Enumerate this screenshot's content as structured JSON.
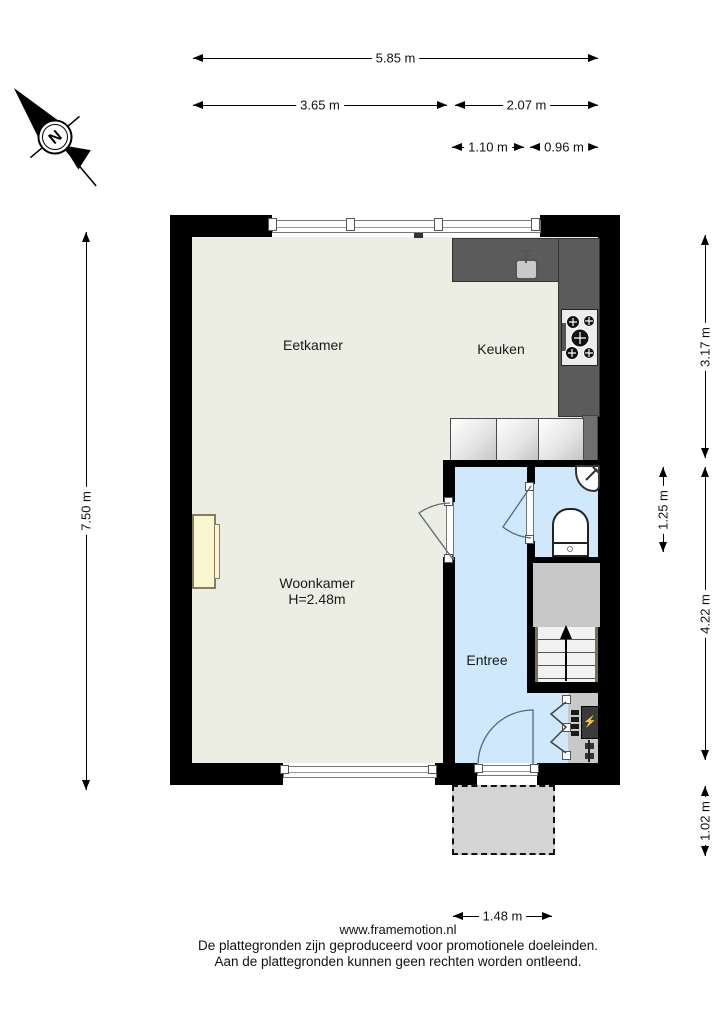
{
  "compass": {
    "north_label": "N"
  },
  "rooms": {
    "eetkamer": {
      "label": "Eetkamer"
    },
    "keuken": {
      "label": "Keuken"
    },
    "woonkamer": {
      "label": "Woonkamer",
      "ceiling_height": "H=2.48m"
    },
    "entree": {
      "label": "Entree"
    }
  },
  "dimensions": {
    "horizontal": [
      {
        "label": "5.85 m",
        "x": 193,
        "y": 58,
        "length": 405
      },
      {
        "label": "3.65 m",
        "x": 193,
        "y": 105,
        "length": 254
      },
      {
        "label": "2.07 m",
        "x": 455,
        "y": 105,
        "length": 143
      },
      {
        "label": "1.10 m",
        "x": 452,
        "y": 147,
        "length": 72
      },
      {
        "label": "0.96 m",
        "x": 530,
        "y": 147,
        "length": 68
      },
      {
        "label": "1.48 m",
        "x": 453,
        "y": 916,
        "length": 99
      }
    ],
    "vertical": [
      {
        "label": "7.50 m",
        "x": 86,
        "y": 232,
        "length": 558
      },
      {
        "label": "3.17 m",
        "x": 705,
        "y": 235,
        "length": 223
      },
      {
        "label": "1.25 m",
        "x": 663,
        "y": 467,
        "length": 85
      },
      {
        "label": "4.22 m",
        "x": 705,
        "y": 467,
        "length": 293
      },
      {
        "label": "1.02 m",
        "x": 705,
        "y": 786,
        "length": 70
      }
    ]
  },
  "fixtures": [
    "kitchen-counter",
    "kitchen-sink",
    "stove-cooktop",
    "kitchen-cabinets",
    "corner-washbasin",
    "toilet",
    "staircase-up",
    "meter-cupboard",
    "electrical-panel",
    "fireplace",
    "front-door",
    "interior-doors",
    "windows",
    "porch"
  ],
  "footer": {
    "website": "www.framemotion.nl",
    "disclaimer_line1": "De plattegronden zijn geproduceerd voor promotionele doeleinden.",
    "disclaimer_line2": "Aan de plattegronden kunnen geen rechten worden ontleend."
  },
  "colors": {
    "wall": "#000000",
    "main_floor": "#ecede3",
    "wet_floor": "#cfe8fb",
    "counter": "#5b5b5b",
    "stairs_landing": "#c8c8c8",
    "porch": "#d4d4d4",
    "fireplace": "#faf6d0",
    "lightning": "#f5c400"
  }
}
